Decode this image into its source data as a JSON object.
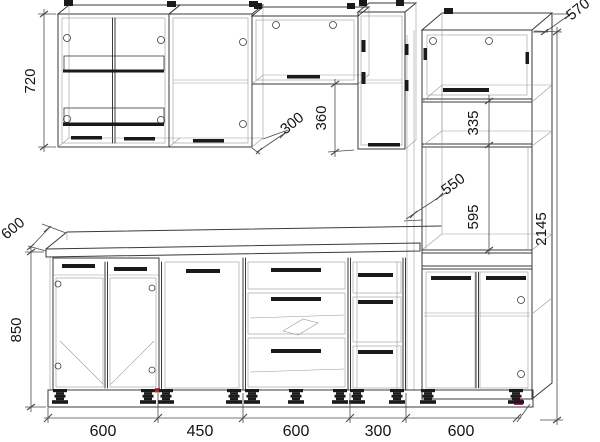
{
  "title": "Kitchen cabinet set technical drawing",
  "dims": {
    "wall_cabinet_height": "720",
    "wall_cabinet_depth": "300",
    "hood_cabinet_height": "360",
    "tall_unit_depth": "570",
    "tall_unit_upper_height": "335",
    "oven_niche_depth": "550",
    "oven_niche_height": "595",
    "total_height": "2145",
    "worktop_depth": "600",
    "base_unit_height": "850",
    "base_widths": [
      "600",
      "450",
      "600",
      "300",
      "600"
    ]
  },
  "colors": {
    "line": "#3a3a3a",
    "light_line": "#9a9a9a",
    "dimension_line": "#4a4a4a",
    "fitting": "#1a1a1a",
    "accent_marker": "#e5007d",
    "hinge_marker": "#d4263a",
    "background": "#ffffff",
    "text": "#141414"
  }
}
